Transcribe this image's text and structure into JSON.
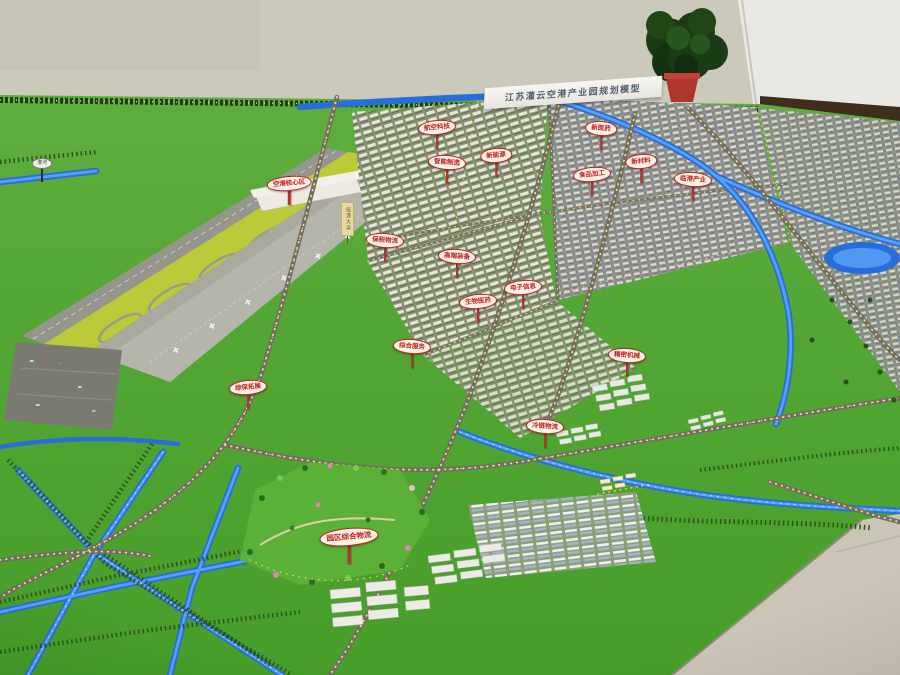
{
  "scene_description": "Photograph of a physical planning scale model: airport on the left, industrial park blocks, glowing blue canals, golden street-light strings, green lawn base, showroom wall and floor visible at edges",
  "title_board": {
    "text": "江苏灌云空港产业园规划模型"
  },
  "zone_signs": [
    {
      "label": "空港核心区"
    },
    {
      "label": "保税物流"
    },
    {
      "label": "航空科技"
    },
    {
      "label": "智能制造"
    },
    {
      "label": "新能源"
    },
    {
      "label": "高端装备"
    },
    {
      "label": "生物医药"
    },
    {
      "label": "综合服务"
    },
    {
      "label": "电子信息"
    },
    {
      "label": "新医药"
    },
    {
      "label": "新材料"
    },
    {
      "label": "临港产业"
    },
    {
      "label": "食品加工"
    },
    {
      "label": "精密机械"
    },
    {
      "label": "综保拓展"
    },
    {
      "label": "冷链物流"
    },
    {
      "label": "园区综合物流"
    }
  ],
  "road_signs": [
    {
      "label": "灌河"
    },
    {
      "label": "临港大道"
    }
  ],
  "colors": {
    "grass": "#58a53c",
    "canal_blue": "#2d6dd2",
    "street_lights": "#ffd87a",
    "sign_red": "#c32222",
    "wall": "#cbc9bb",
    "runway_grey": "#96968e",
    "floor": "#cbc5b8"
  }
}
